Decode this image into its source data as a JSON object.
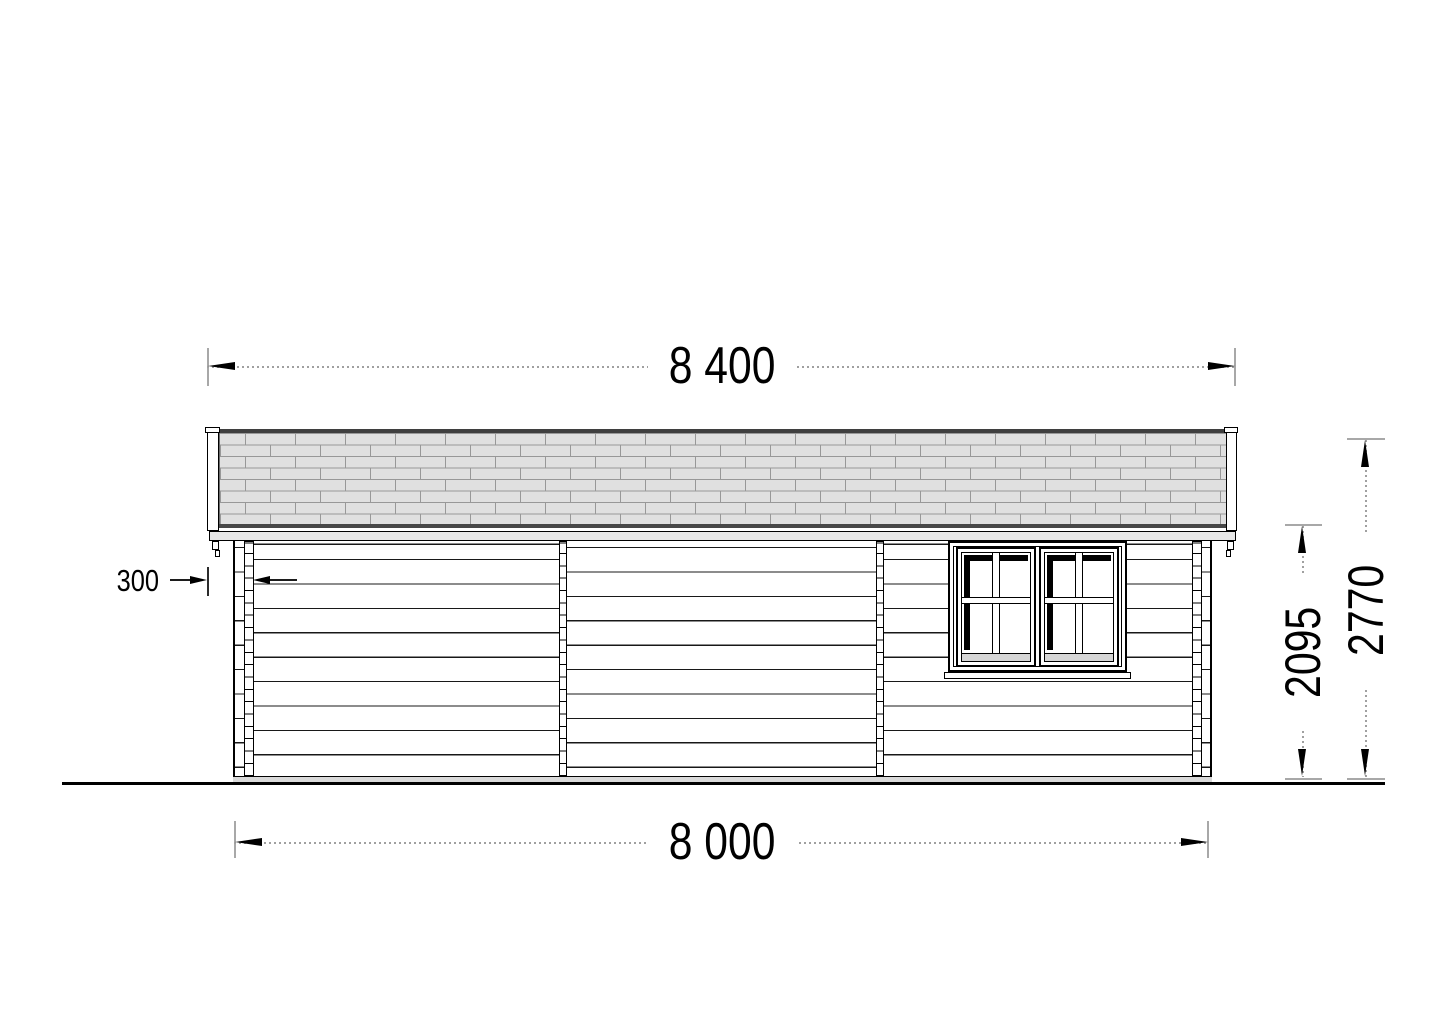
{
  "drawing": {
    "view": "side-elevation",
    "dimensions": {
      "roof_width_mm": "8 400",
      "base_width_mm": "8 000",
      "roof_overhang_mm": "300",
      "eave_height_mm": "2095",
      "total_height_mm": "2770"
    },
    "colors": {
      "ridge_strip": "#3f3f3f",
      "eave_strip": "#474747",
      "shingle_fill": "#e0e0e0",
      "shingle_line": "#989898",
      "fascia_fill": "#e7e7e7",
      "foundation_fill": "#d9d9d9",
      "rail_fill": "#d6d6d6",
      "dim_line": "#a0a0a0",
      "dim_tick": "#a8a8a8",
      "dim_text": "#000000"
    }
  }
}
